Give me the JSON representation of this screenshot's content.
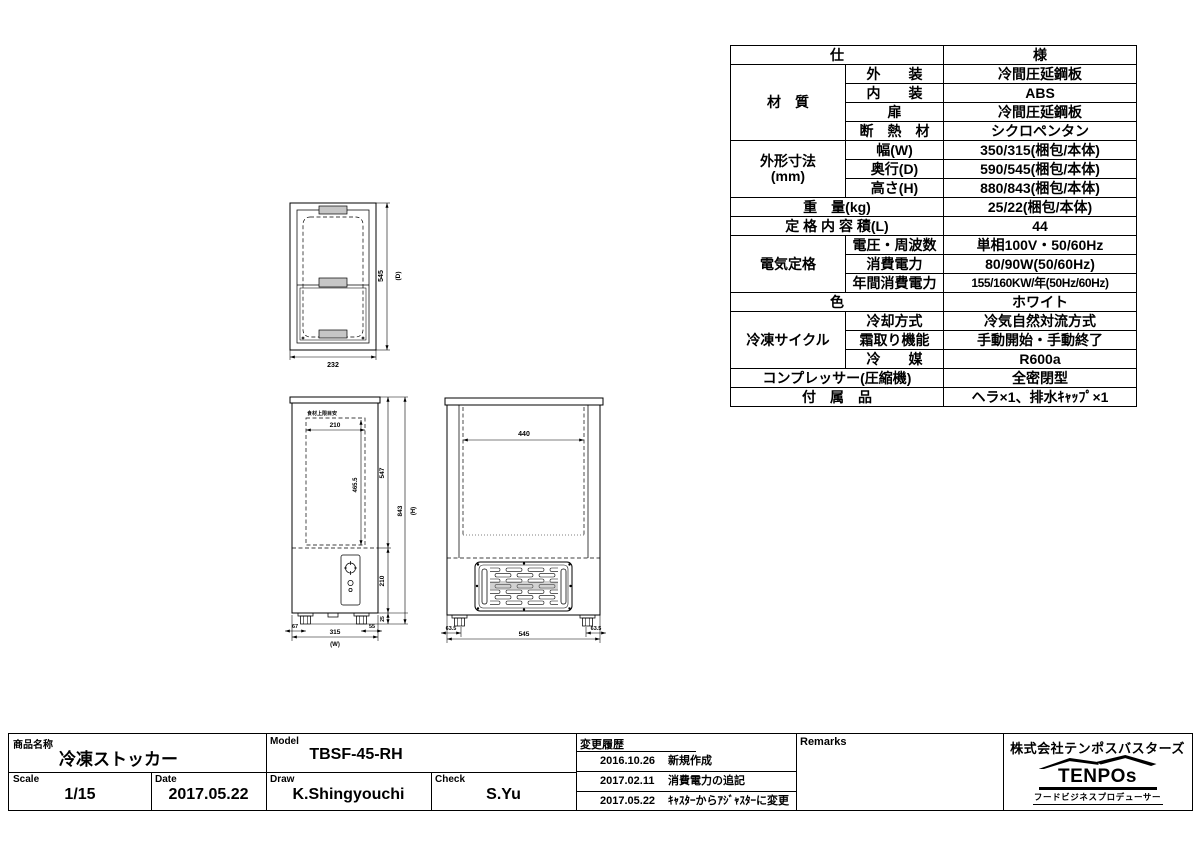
{
  "spec_table": {
    "rows": [
      [
        {
          "t": "仕",
          "cs": 2
        },
        {
          "t": "様"
        }
      ],
      [
        {
          "t": "材　質",
          "rs": 4
        },
        {
          "t": "外　　装"
        },
        {
          "t": "冷間圧延鋼板"
        }
      ],
      [
        {
          "t": "内　　装"
        },
        {
          "t": "ABS"
        }
      ],
      [
        {
          "t": "扉"
        },
        {
          "t": "冷間圧延鋼板"
        }
      ],
      [
        {
          "t": "断　熱　材"
        },
        {
          "t": "シクロペンタン"
        }
      ],
      [
        {
          "t": "外形寸法\n(mm)",
          "rs": 3
        },
        {
          "t": "幅(W)"
        },
        {
          "t": "350/315(梱包/本体)"
        }
      ],
      [
        {
          "t": "奥行(D)"
        },
        {
          "t": "590/545(梱包/本体)"
        }
      ],
      [
        {
          "t": "高さ(H)"
        },
        {
          "t": "880/843(梱包/本体)"
        }
      ],
      [
        {
          "t": "重　量(kg)",
          "cs": 2
        },
        {
          "t": "25/22(梱包/本体)"
        }
      ],
      [
        {
          "t": "定 格 内 容 積(L)",
          "cs": 2
        },
        {
          "t": "44"
        }
      ],
      [
        {
          "t": "電気定格",
          "rs": 3
        },
        {
          "t": "電圧・周波数"
        },
        {
          "t": "単相100V・50/60Hz"
        }
      ],
      [
        {
          "t": "消費電力"
        },
        {
          "t": "80/90W(50/60Hz)"
        }
      ],
      [
        {
          "t": "年間消費電力"
        },
        {
          "t": "155/160KW/年(50Hz/60Hz)",
          "fit": 1
        }
      ],
      [
        {
          "t": "色",
          "cs": 2
        },
        {
          "t": "ホワイト"
        }
      ],
      [
        {
          "t": "冷凍サイクル",
          "rs": 3
        },
        {
          "t": "冷却方式"
        },
        {
          "t": "冷気自然対流方式"
        }
      ],
      [
        {
          "t": "霜取り機能"
        },
        {
          "t": "手動開始・手動終了"
        }
      ],
      [
        {
          "t": "冷　　媒"
        },
        {
          "t": "R600a"
        }
      ],
      [
        {
          "t": "コンプレッサー(圧縮機)",
          "cs": 2
        },
        {
          "t": "全密閉型"
        }
      ],
      [
        {
          "t": "付　属　品",
          "cs": 2
        },
        {
          "t": "ヘラ×1、排水ｷｬｯﾌﾟ×1"
        }
      ]
    ]
  },
  "drawings": {
    "top_view": {
      "width": "232",
      "depth": "545",
      "depth_suffix": "(D)"
    },
    "side_view": {
      "food_limit_label": "食材上限目安",
      "inner_width": "210",
      "inner_height": "465.5",
      "upper_height": "547",
      "machine_height": "210",
      "foot_height": "25",
      "total_height": "843",
      "total_height_suffix": "(H)",
      "foot_left": "67",
      "body_width": "315",
      "body_width_suffix": "(W)",
      "foot_right": "55"
    },
    "front_view": {
      "inner_width": "440",
      "foot_left": "63.5",
      "body_width": "545",
      "foot_right": "63.5"
    }
  },
  "title_block": {
    "product_label": "商品名称",
    "product_name": "冷凍ストッカー",
    "model_label": "Model",
    "model": "TBSF-45-RH",
    "scale_label": "Scale",
    "scale": "1/15",
    "date_label": "Date",
    "date": "2017.05.22",
    "draw_label": "Draw",
    "draw": "K.Shingyouchi",
    "check_label": "Check",
    "check": "S.Yu",
    "history_label": "変更履歴",
    "history": [
      {
        "date": "2016.10.26",
        "desc": "新規作成"
      },
      {
        "date": "2017.02.11",
        "desc": "消費電力の追記"
      },
      {
        "date": "2017.05.22",
        "desc": "ｷｬｽﾀｰからｱｼﾞｬｽﾀｰに変更"
      }
    ],
    "remarks_label": "Remarks",
    "company": {
      "name": "株式会社テンポスバスターズ",
      "logo_text": "TENPOs",
      "tagline": "フードビジネスプロデューサー"
    }
  },
  "colors": {
    "line": "#000000",
    "paper": "#ffffff",
    "handle_fill": "#c6c6c6"
  }
}
